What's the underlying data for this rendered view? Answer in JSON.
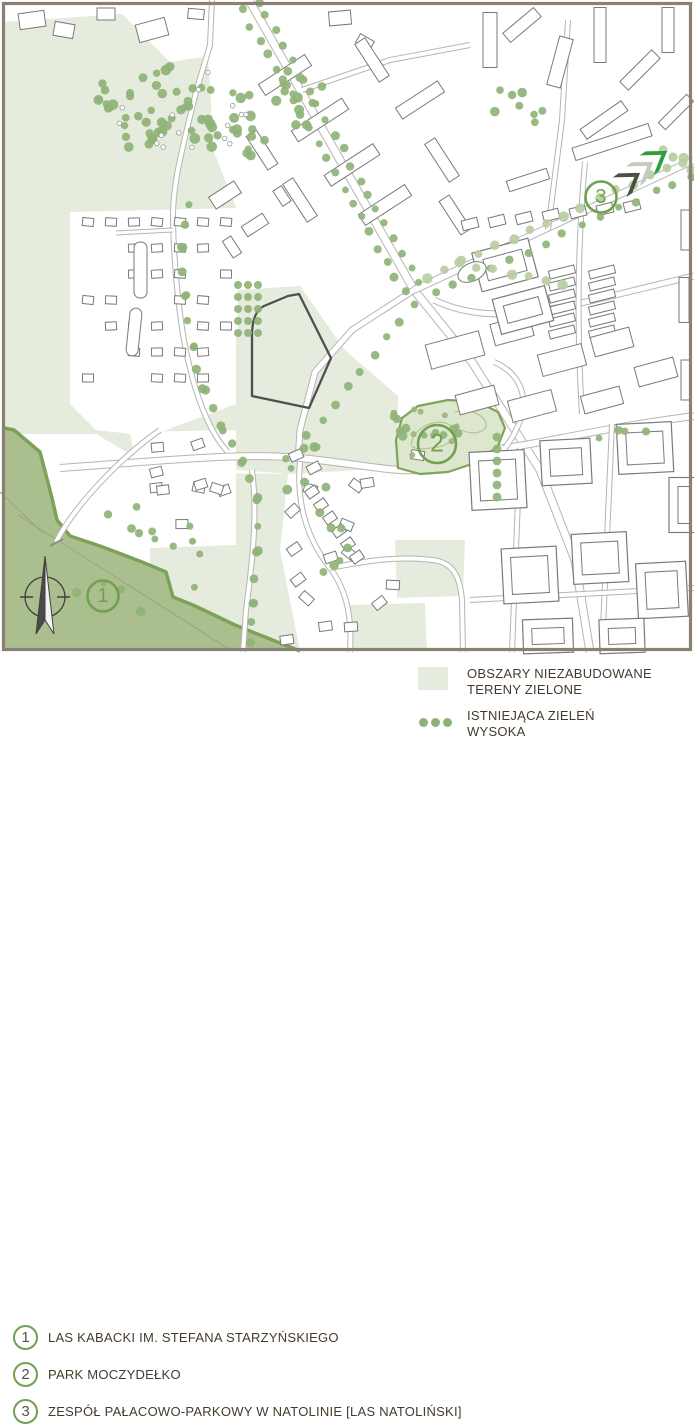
{
  "map": {
    "type": "urban-green-areas-plan",
    "markers": [
      {
        "number": "1",
        "x": 103,
        "y": 596,
        "r": 15.5,
        "label": "LAS KABACKI IM. STEFANA STARZYŃSKIEGO"
      },
      {
        "number": "2",
        "x": 437,
        "y": 444,
        "r": 19,
        "label": "PARK MOCZYDEŁKO"
      },
      {
        "number": "3",
        "x": 601,
        "y": 197,
        "r": 15.5,
        "label": "ZESPÓŁ PAŁACOWO-PARKOWY W NATOLINIE [LAS NATOLIŃSKI]"
      }
    ],
    "icons": [
      "north-arrow-compass-icon",
      "triple-chevron-arrows-icon"
    ],
    "colors": {
      "frame": "#8a8174",
      "pale_green_area": "#e6ecdd",
      "forest_fill": "#abbf8e",
      "forest_stroke": "#7ca257",
      "park_fill": "#dce7cd",
      "park_stroke": "#7da45a",
      "tree": "#8fb377",
      "tree_light": "#b8cda2",
      "road": "#b5b5b5",
      "building": "#7a7a7a",
      "site_outline": "#4f4f4f",
      "marker_green": "#73a050",
      "chevron_dark": "#46543f",
      "chevron_gray": "#c7cabf",
      "chevron_green": "#2f9e3b",
      "compass": "#3f3f3f"
    }
  },
  "legend": {
    "items": [
      {
        "number": "1",
        "label": "LAS KABACKI IM. STEFANA STARZYŃSKIEGO"
      },
      {
        "number": "2",
        "label": "PARK MOCZYDEŁKO"
      },
      {
        "number": "3",
        "label": "ZESPÓŁ PAŁACOWO-PARKOWY W NATOLINIE [LAS NATOLIŃSKI]"
      }
    ],
    "area_items": [
      {
        "icon": "green-area-swatch",
        "line1": "OBSZARY NIEZABUDOWANE",
        "line2": "TERENY ZIELONE"
      },
      {
        "icon": "tree-dots-swatch",
        "line1": "ISTNIEJĄCA ZIELEŃ",
        "line2": "WYSOKA"
      }
    ]
  }
}
